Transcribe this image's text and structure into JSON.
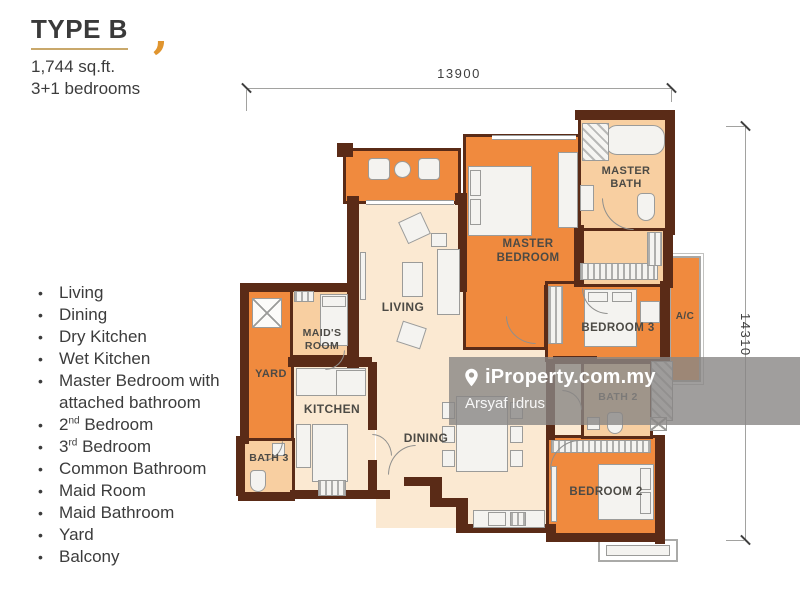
{
  "header": {
    "type_label": "TYPE B",
    "accent_mark": ",",
    "area": "1,744 sq.ft.",
    "bedrooms": "3+1 bedrooms"
  },
  "features": {
    "bullet": "•",
    "items": [
      {
        "text": "Living"
      },
      {
        "text": "Dining"
      },
      {
        "text": "Dry Kitchen"
      },
      {
        "text": "Wet Kitchen"
      },
      {
        "text": "Master Bedroom with attached bathroom"
      },
      {
        "num": "2",
        "sup": "nd",
        "rest": " Bedroom"
      },
      {
        "num": "3",
        "sup": "rd",
        "rest": " Bedroom"
      },
      {
        "text": "Common Bathroom"
      },
      {
        "text": "Maid Room"
      },
      {
        "text": "Maid Bathroom"
      },
      {
        "text": "Yard"
      },
      {
        "text": "Balcony"
      }
    ]
  },
  "plan": {
    "dimensions": {
      "width_label": "13900",
      "height_label": "14310"
    },
    "rooms": {
      "living": "LIVING",
      "dining": "DINING",
      "kitchen": "KITCHEN",
      "master_bedroom": "MASTER BEDROOM",
      "master_bath": "MASTER BATH",
      "bedroom_2": "BEDROOM 2",
      "bedroom_3": "BEDROOM 3",
      "bath_2": "BATH 2",
      "bath_3": "BATH 3",
      "maids_room": "MAID'S ROOM",
      "yard": "YARD",
      "ac": "A/C"
    },
    "colors": {
      "wall": "#5a2b17",
      "room_orange": "#f08a3e",
      "room_light_orange": "#f8cfa1",
      "room_cream": "#fbe9d2",
      "accent": "#e0952f"
    }
  },
  "watermark": {
    "brand": "iProperty.com.my",
    "agent": "Arsyaf Idrus"
  }
}
